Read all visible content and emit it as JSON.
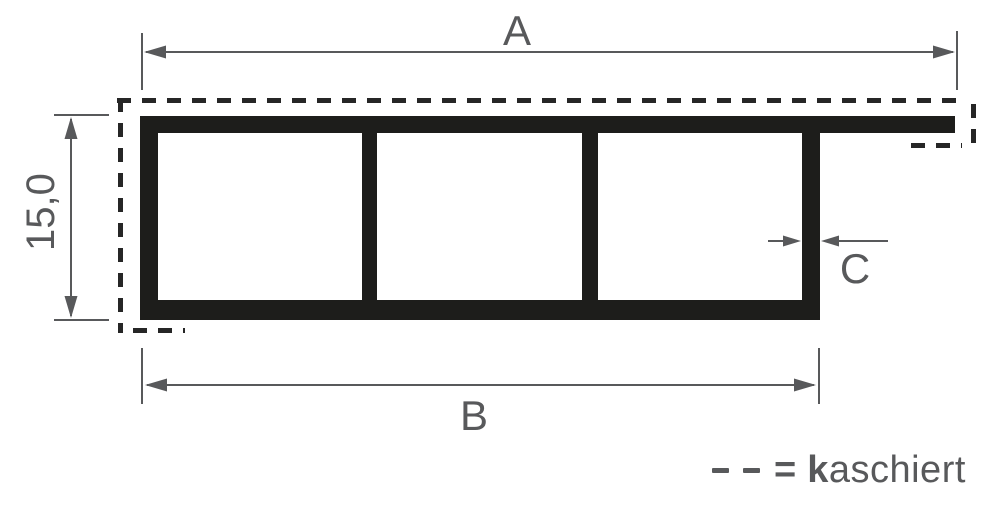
{
  "colors": {
    "background": "#ffffff",
    "profile": "#1d1d1b",
    "dimension": "#58595b",
    "laminated_outline": "#262626"
  },
  "dimension_labels": {
    "overall_width": "A",
    "body_width": "B",
    "profile_height": "15,0",
    "wall_thickness": "C"
  },
  "legend": {
    "equals_sign": "=",
    "term_bold_initial": "k",
    "term_remainder": "aschiert"
  }
}
